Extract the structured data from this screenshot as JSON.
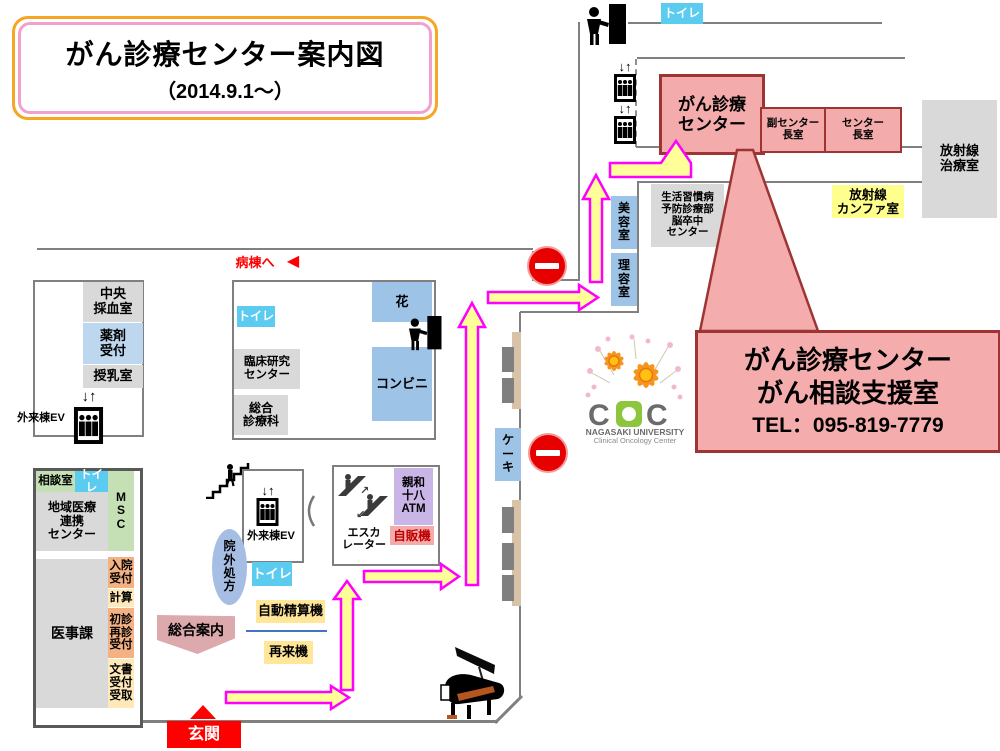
{
  "title": {
    "main": "がん診療センター案内図",
    "date": "（2014.9.1～）"
  },
  "callout": {
    "line1": "がん診療センター",
    "line2": "がん相談支援室",
    "tel": "TEL：095-819-7779"
  },
  "labels": {
    "toilet": "トイレ",
    "cancer_center": "がん診療\nセンター",
    "vice_director_room": "副センター\n長室",
    "director_room": "センター\n長室",
    "radiation_treatment": "放射線\n治療室",
    "radiation_conference": "放射線\nカンファ室",
    "lifestyle_center": "生活習慣病\n予防診療部\n脳卒中\nセンター",
    "beauty_room": "美\n容\n室",
    "barber_room": "理\n容\n室",
    "to_ward": "病棟へ",
    "to_ward_arrow": "◀",
    "central_blood_room": "中央\n採血室",
    "pharmacy_reception": "薬剤\n受付",
    "nursing_room": "授乳室",
    "outpatient_ev": "外来棟EV",
    "ev_arrows": "↓↑",
    "clinical_research_center": "臨床研究\nセンター",
    "general_clinic": "総合\n診療科",
    "flower_shop": "花",
    "convenience_store": "コンビニ",
    "cake_shop": "ケ\nー\nキ",
    "consultation_room": "相談室",
    "msc": "M\nS\nC",
    "regional_center": "地域医療\n連携\nセンター",
    "admission_reception": "入院\n受付",
    "calculation": "計算",
    "first_revisit_reception": "初診\n再診\n受付",
    "document_reception": "文書\n受付\n受取",
    "medical_affairs": "医事課",
    "outside_prescription": "院\n外\n処\n方",
    "escalator": "エスカ\nレーター",
    "atm": "親和\n十八\nATM",
    "vending_machine": "自販機",
    "auto_payment_machine": "自動精算機",
    "revisit_machine": "再来機",
    "information_desk": "総合案内",
    "entrance": "玄関"
  },
  "logo": {
    "c_left": "C",
    "c_right": "C",
    "university": "NAGASAKI UNIVERSITY",
    "center": "Clinical Oncology Center"
  },
  "colors": {
    "room_pink": "#F4ABAB",
    "dark_red": "#9E3434",
    "toilet_cyan": "#5BCBF0",
    "shop_blue": "#9DC3E6",
    "room_gray": "#D9D9D9",
    "pharmacy_blue": "#BDD7EE",
    "green": "#C5E0B4",
    "orange": "#F4B183",
    "cream": "#FFE9B8",
    "machine_yellow": "#FFE699",
    "conference_yellow": "#FFFF8D",
    "atm_purple": "#C9B5E6",
    "info_rose": "#DCA9AC",
    "prescription_blue": "#A6BEE4",
    "signal_red": "#FF0000",
    "arrow_fill": "#FFFF99",
    "arrow_stroke": "#FF00FF",
    "wall": "#808080",
    "bench_tan": "#D9C3A8",
    "bench_gray": "#7F7F7F"
  }
}
